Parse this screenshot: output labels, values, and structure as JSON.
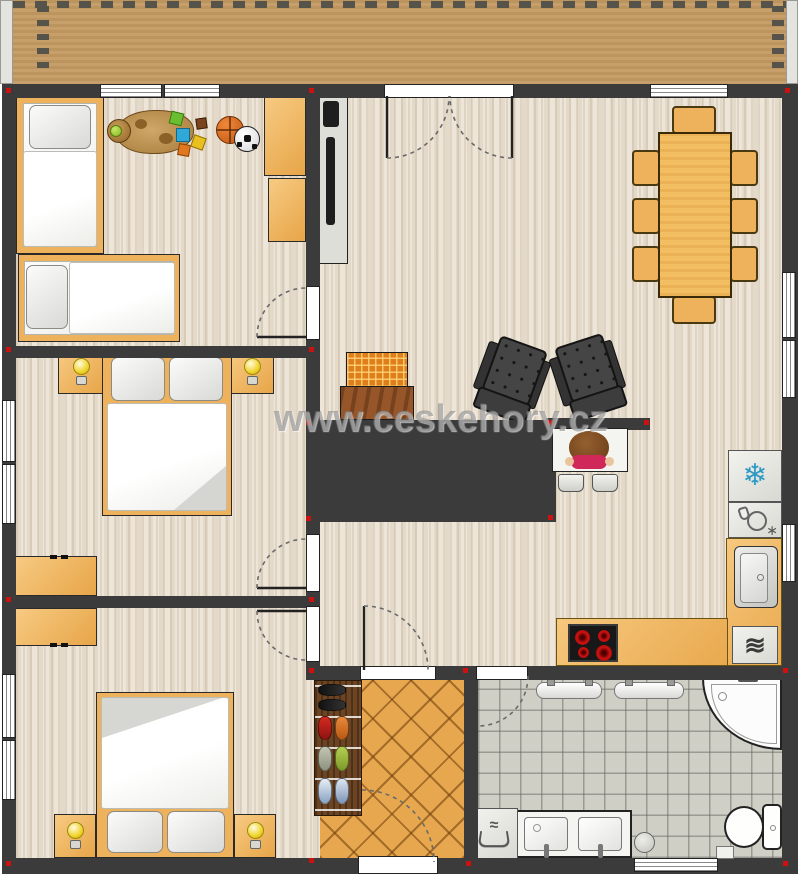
{
  "watermark": {
    "text": "www.ceskehory.cz"
  },
  "icons": {
    "fridge_snowflake": "❄",
    "washer_waves": "≋",
    "dishwasher_sparkle": "∗",
    "laundry_wave": "≈"
  },
  "palette": {
    "wall": "#3b3b3b",
    "floor_wood": "#ebe2d4",
    "balcony": "#c49a62",
    "furniture_orange": "#efb25c",
    "table_wood": "#f3bd62",
    "entry_tile": "#e7a74f",
    "bath_tile": "#cfcfc6",
    "appliance_gray": "#e6e6e1",
    "marker_red": "#cc1111",
    "snowflake_blue": "#2e9ac4",
    "watermark_gray": "#787878"
  }
}
